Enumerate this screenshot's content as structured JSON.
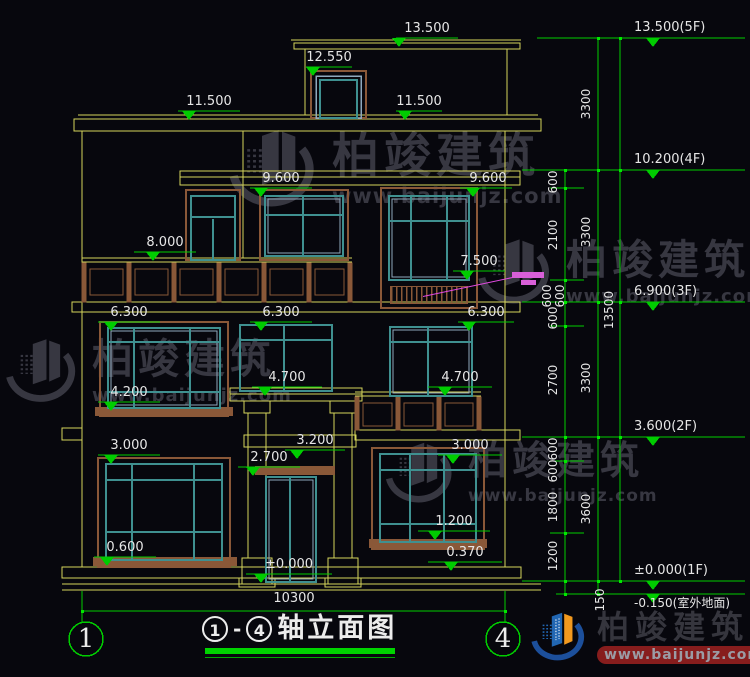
{
  "drawing_title": "①-④轴立面图",
  "elev": {
    "e13500": "13.500",
    "e12550": "12.550",
    "e11500L": "11.500",
    "e11500R": "11.500",
    "e9600L": "9.600",
    "e9600R": "9.600",
    "e8000": "8.000",
    "e7500": "7.500",
    "e6300L": "6.300",
    "e6300M": "6.300",
    "e6300R": "6.300",
    "e4700L": "4.700",
    "e4700R": "4.700",
    "e4200": "4.200",
    "e3200": "3.200",
    "e3000L": "3.000",
    "e3000R": "3.000",
    "e2700": "2.700",
    "e1200": "1.200",
    "e0600": "0.600",
    "e0370": "0.370",
    "e0000": "±0.000"
  },
  "levels": {
    "f5": "13.500(5F)",
    "f4": "10.200(4F)",
    "f3": "6.900(3F)",
    "f2": "3.600(2F)",
    "f1": "±0.000(1F)",
    "ground": "-0.150(室外地面)"
  },
  "dims": {
    "w_total": "10300",
    "seg1": "600",
    "seg2": "2100",
    "seg3": "600",
    "seg4": "600",
    "seg5": "600",
    "seg6": "2700",
    "seg7": "600",
    "seg8": "600",
    "seg9": "1800",
    "seg10": "1200",
    "seg11": "150",
    "fl1": "3300",
    "fl2": "3300",
    "fl3": "3300",
    "fl4": "3600",
    "total_h": "13500"
  },
  "footer": {
    "axis_left": "1",
    "axis_right": "4",
    "t_no1": "1",
    "t_dash": "-",
    "t_no4": "4",
    "t_name": "轴立面图"
  },
  "watermark": {
    "brand": "柏竣建筑",
    "site": "www.baijunjz.com"
  },
  "colors": {
    "background": "#07070d",
    "line_yellow": "#d4d45c",
    "dim_green": "#00cc00",
    "frame_teal": "#3f9090",
    "sash_blue": "#8fa9bd",
    "accent_brown": "#8a5838",
    "text_white": "#e6e6e6",
    "leader_magenta": "#e24ae2",
    "watermark_gray": "#3a3a44",
    "logo_blue": "#2166b2",
    "logo_orange": "#f2991e"
  }
}
